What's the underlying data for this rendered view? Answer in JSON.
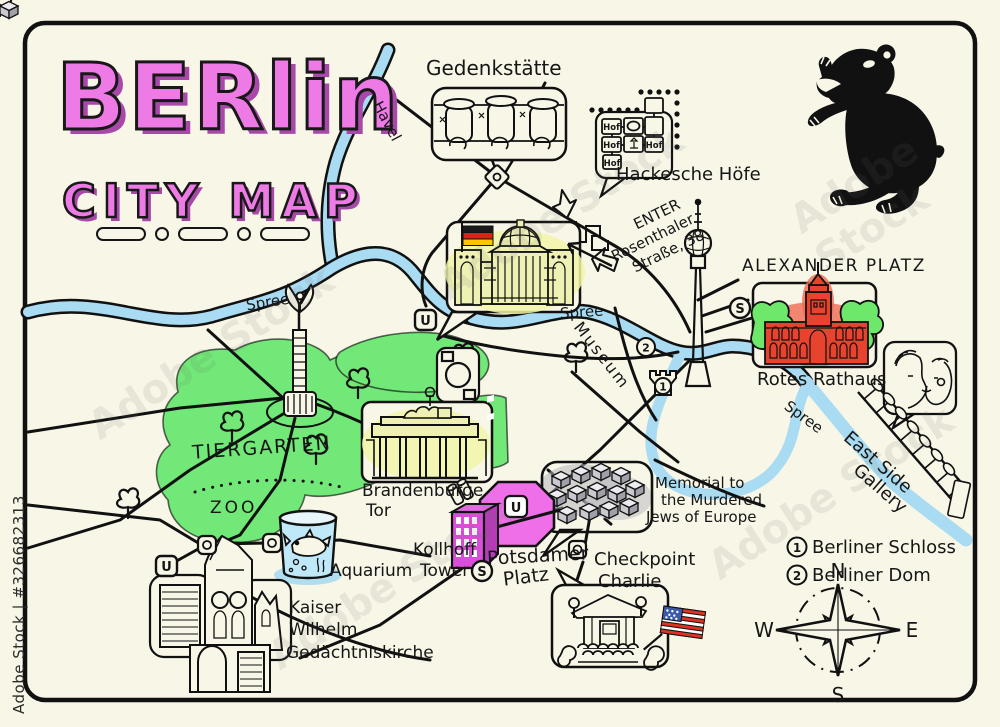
{
  "title": {
    "line1": "BERlin",
    "line2": "CITY MAP"
  },
  "watermark": {
    "side": "Adobe Stock | #326682313",
    "diagonal": "Adobe Stock"
  },
  "rivers": {
    "havel": "Havel",
    "spree": "Spree"
  },
  "landmarks": {
    "gedenkstaette": "Gedenkstätte",
    "hackesche_hoefe": "Hackesche Höfe",
    "hof": "Hof",
    "alexanderplatz": "ALEXANDER PLATZ",
    "rotes_rathaus": "Rotes Rathaus",
    "east_side_line1": "East Side",
    "east_side_line2": "Gallery",
    "memorial_line1": "Memorial to",
    "memorial_line2": "the Murdered",
    "memorial_line3": "Jews of Europe",
    "checkpoint_line1": "Checkpoint",
    "checkpoint_line2": "Charlie",
    "potsdamer_line1": "Potsdamer",
    "potsdamer_line2": "Platz",
    "kollhoff_line1": "Kollhoff",
    "kollhoff_line2": "Tower",
    "brandenburger_line1": "Brandenburge",
    "brandenburger_line2": "Tor",
    "tiergarten": "TIERGARTEN",
    "zoo": "ZOO",
    "aquarium": "Aquarium",
    "kaiser_line1": "Kaiser",
    "kaiser_line2": "Wilhelm",
    "kaiser_line3": "Gedächtniskirche",
    "museum": "Museum",
    "enter_line1": "ENTER",
    "enter_line2": "Rosenthaler",
    "enter_line3": "Straße, 38"
  },
  "legend": {
    "item1_num": "1",
    "item1_label": "Berliner Schloss",
    "item2_num": "2",
    "item2_label": "Berliner Dom"
  },
  "compass": {
    "north": "N",
    "east": "E",
    "south": "S",
    "west": "W"
  },
  "markers": {
    "u": "U",
    "s": "S",
    "num1": "1",
    "num2": "2"
  },
  "colors": {
    "background": "#f8f6e7",
    "river": "#a9dcf2",
    "park": "#71e877",
    "title_pink": "#ee7ae6",
    "title_side": "#a848a8",
    "building_yellow": "#eef0b4",
    "yellow_glow": "#f2f4a8",
    "rathaus_red": "#e8432f",
    "red_glow": "#f06a52",
    "tower_magenta": "#d94fd9",
    "platz_pink": "#ee6fe8",
    "cube_gray": "#c9c9cf",
    "flag_red": "#dd2211",
    "flag_gold": "#f7c700",
    "us_flag_blue": "#3b5ba5",
    "bear_black": "#111111"
  }
}
